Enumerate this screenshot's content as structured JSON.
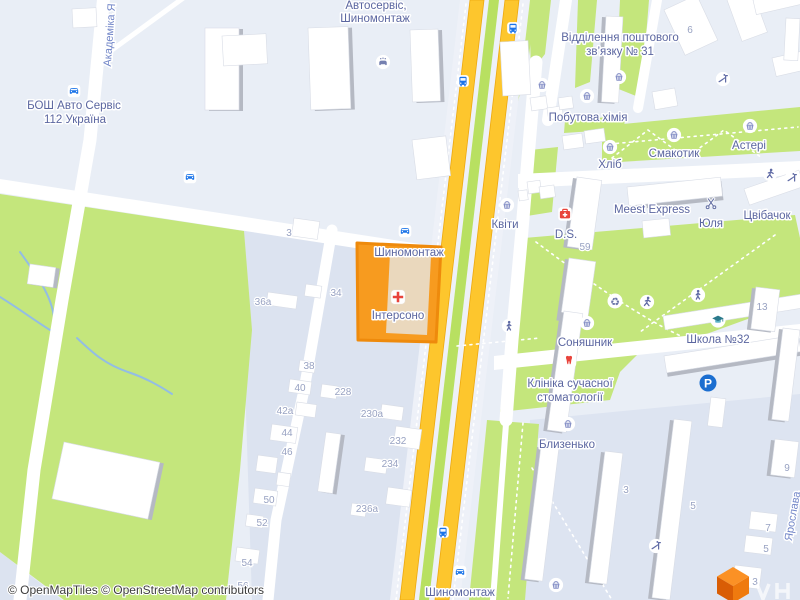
{
  "map": {
    "attribution": "© OpenMapTiles © OpenStreetMap contributors",
    "selected_poi": "Інтерсоно"
  },
  "streets": {
    "left_vertical": "Академіка Я",
    "right_vertical": "Ярослава"
  },
  "pois": [
    {
      "id": "autoservice-top",
      "lines": [
        "Автосервіс,",
        "Шиномонтаж"
      ]
    },
    {
      "id": "bosch-auto",
      "lines": [
        "БОШ Авто Сервіс",
        "112 Україна"
      ]
    },
    {
      "id": "post-office",
      "lines": [
        "Відділення поштового",
        "зв’язку № 31"
      ]
    },
    {
      "id": "household-chemicals",
      "lines": [
        "Побутова хімія"
      ]
    },
    {
      "id": "bread-shop",
      "lines": [
        "Хліб"
      ]
    },
    {
      "id": "smakotyk",
      "lines": [
        "Смакотик"
      ]
    },
    {
      "id": "asteri",
      "lines": [
        "Астері"
      ]
    },
    {
      "id": "flowers",
      "lines": [
        "Квіти"
      ]
    },
    {
      "id": "meest-express",
      "lines": [
        "Meest Express"
      ]
    },
    {
      "id": "yulia",
      "lines": [
        "Юля"
      ]
    },
    {
      "id": "tsvibachok",
      "lines": [
        "Цвібачок"
      ]
    },
    {
      "id": "ds-pharmacy",
      "lines": [
        "D.S."
      ]
    },
    {
      "id": "tire-service-center",
      "lines": [
        "Шиномонтаж"
      ]
    },
    {
      "id": "intersono",
      "lines": [
        "Інтерсоно"
      ]
    },
    {
      "id": "soniashnyk",
      "lines": [
        "Соняшник"
      ]
    },
    {
      "id": "school-32",
      "lines": [
        "Школа №32"
      ]
    },
    {
      "id": "dental-clinic",
      "lines": [
        "Клініка сучасної",
        "стоматології"
      ]
    },
    {
      "id": "blyzenko",
      "lines": [
        "Близенько"
      ]
    },
    {
      "id": "tire-service-bottom",
      "lines": [
        "Шиномонтаж"
      ]
    }
  ],
  "house_numbers": [
    "3",
    "34",
    "36а",
    "38",
    "40",
    "42а",
    "44",
    "46",
    "50",
    "52",
    "54",
    "56",
    "228",
    "230а",
    "232",
    "234",
    "236а",
    "6",
    "59",
    "13",
    "3",
    "5",
    "9",
    "7",
    "5",
    "3"
  ],
  "icons": {
    "parking_letter": "P",
    "recycle_glyph": "♻",
    "legend": {
      "shop-basket-icon": "blue basket in white circle",
      "bus-stop-icon": "blue bus in white square",
      "car-repair-icon": "blue car in white square",
      "car-wash-icon": "car with water drops",
      "hairdresser-icon": "scissors",
      "pharmacy-icon": "red first-aid kit",
      "medical-cross-icon": "red cross in white square",
      "dentist-icon": "red tooth",
      "school-icon": "graduation cap",
      "parking-icon": "white P on blue circle",
      "pedestrian-icon": "walking person",
      "running-icon": "running person",
      "playground-icon": "slide",
      "maptiler-logo": "orange 3D cube"
    }
  },
  "colors": {
    "road_yellow": "#fdc62d",
    "green_area": "#c4e67c",
    "selected_fill": "#f79b1f",
    "selected_outline": "#ee8a0c",
    "transport_blue": "#1a73e8",
    "medical_red": "#e8433b",
    "label_blue": "#5b66a0"
  }
}
